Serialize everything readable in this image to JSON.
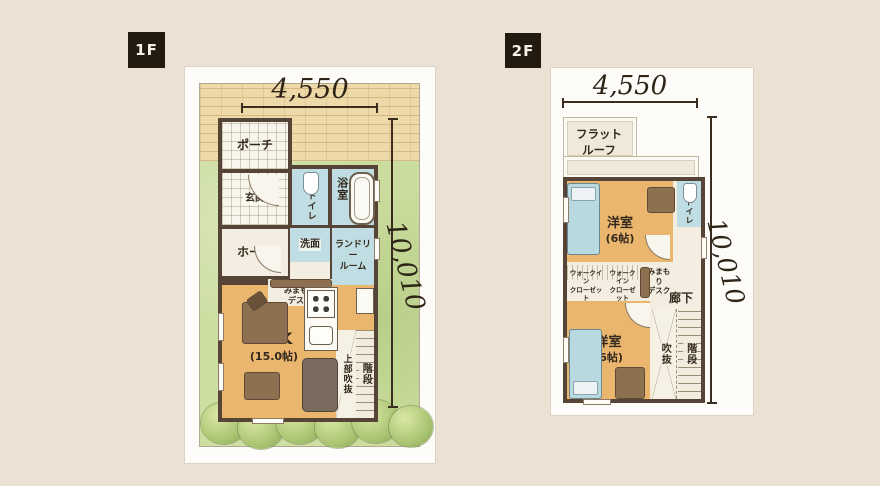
{
  "page": {
    "background": "#ebe2d4"
  },
  "colors": {
    "wall": "#564437",
    "floor_orange": "#eab66e",
    "wet_blue": "#bfdde2",
    "grass": "#cbdd9e",
    "brick": "#eedaa9",
    "card": "#fdfcf8",
    "tag_bg": "#231a10",
    "dim_text": "#2f2418"
  },
  "floor1": {
    "tag": "1F",
    "dim_width": "4,550",
    "dim_height": "10,010",
    "rooms": {
      "porch": "ポーチ",
      "genkan": "玄関",
      "toilet": "トイレ",
      "bath": "浴室",
      "washroom": "洗面",
      "laundry1": "ランドリー",
      "laundry2": "ルーム",
      "hall": "ホール",
      "desk1": "みまもり",
      "desk2": "デスク",
      "ldk1": "LDK",
      "ldk2": "(15.0帖)",
      "upper_void": "上部吹抜",
      "stairs": "階段"
    }
  },
  "floor2": {
    "tag": "2F",
    "dim_width": "4,550",
    "dim_height": "10,010",
    "rooms": {
      "flat_roof1": "フラット",
      "flat_roof2": "ルーフ",
      "bedroom_a1": "洋室",
      "bedroom_a2": "(6帖)",
      "toilet": "トイレ",
      "wic_a1": "ウォークイン",
      "wic_a2": "クローゼット",
      "wic_b1": "ウォークイン",
      "wic_b2": "クローゼット",
      "desk1": "みまもり",
      "desk2": "デスク",
      "corridor": "廊下",
      "bedroom_b1": "洋室",
      "bedroom_b2": "(6帖)",
      "void": "吹抜",
      "stairs": "階段"
    }
  }
}
